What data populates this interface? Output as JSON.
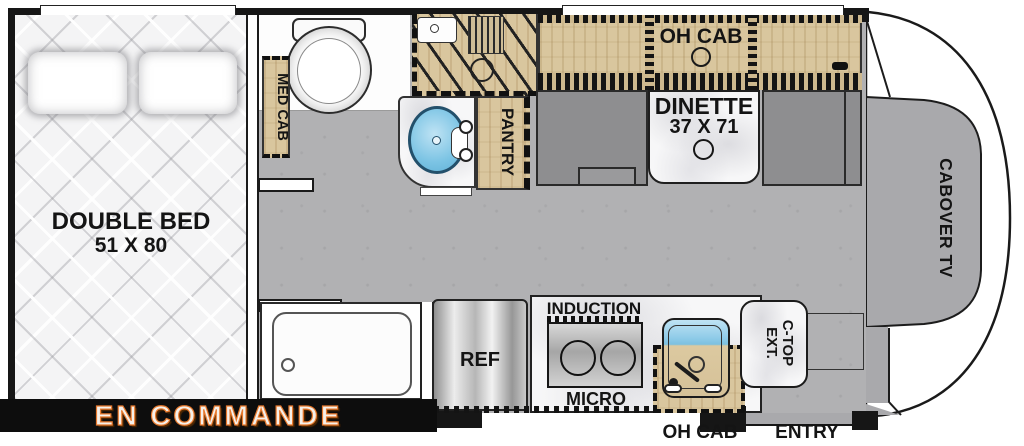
{
  "banner": {
    "label": "EN COMMANDE"
  },
  "colors": {
    "wall_black": "#161616",
    "wood_tan": "#d9c69e",
    "floor_gray": "#b1b1b3",
    "bench_gray": "#8e8e90",
    "sink_blue": "#7cc4e4",
    "marble_white": "#f7f7f8",
    "accent_orange": "#e87a2e"
  },
  "labels": {
    "double_bed": "DOUBLE BED",
    "double_bed_size": "51 X 80",
    "med_cab": "MED CAB",
    "pantry": "PANTRY",
    "oh_cab_top": "OH CAB",
    "dinette": "DINETTE",
    "dinette_size": "37 X 71",
    "cabover_tv": "CABOVER TV",
    "ref": "REF",
    "induction": "INDUCTION",
    "micro": "MICRO",
    "oh_cab_kitchen": "OH CAB",
    "ctop_line1": "C-TOP",
    "ctop_line2": "EXT.",
    "entry": "ENTRY"
  }
}
